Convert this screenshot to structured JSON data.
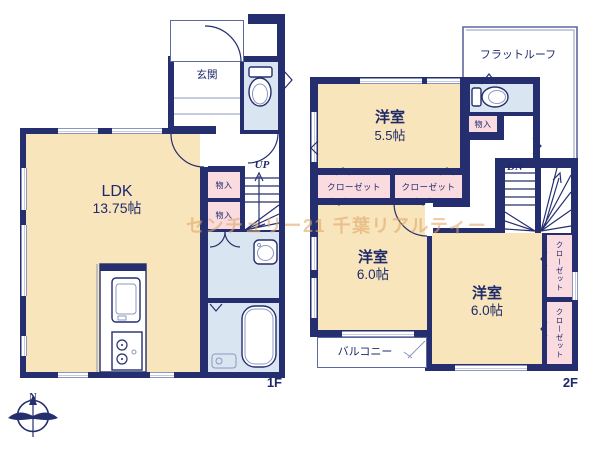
{
  "watermark": "センチュリー21 千葉リアルティー",
  "compass": {
    "north": "N"
  },
  "floor1": {
    "label": "1F",
    "entrance": "玄関",
    "ldk_name": "LDK",
    "ldk_size": "13.75帖",
    "storage_a": "物入",
    "storage_b": "物入",
    "up": "UP"
  },
  "floor2": {
    "label": "2F",
    "flat_roof": "フラットルーフ",
    "room1_name": "洋室",
    "room1_size": "5.5帖",
    "storage": "物入",
    "closet_a": "クローゼット",
    "closet_b": "クローゼット",
    "dn": "DN",
    "room2_name": "洋室",
    "room2_size": "6.0帖",
    "room3_name": "洋室",
    "room3_size": "6.0帖",
    "closet_c": "クローゼット",
    "closet_d": "クローゼット",
    "balcony": "バルコニー"
  },
  "colors": {
    "wall": "#252e6e",
    "room_cream": "#f8e5bb",
    "closet_pink": "#f9dbe0",
    "wet_blue": "#d9e6f2",
    "thin_line": "#8d97bd",
    "roof_line": "#5d68a0",
    "text": "#1f2a6b",
    "watermark": "#dfa869"
  }
}
